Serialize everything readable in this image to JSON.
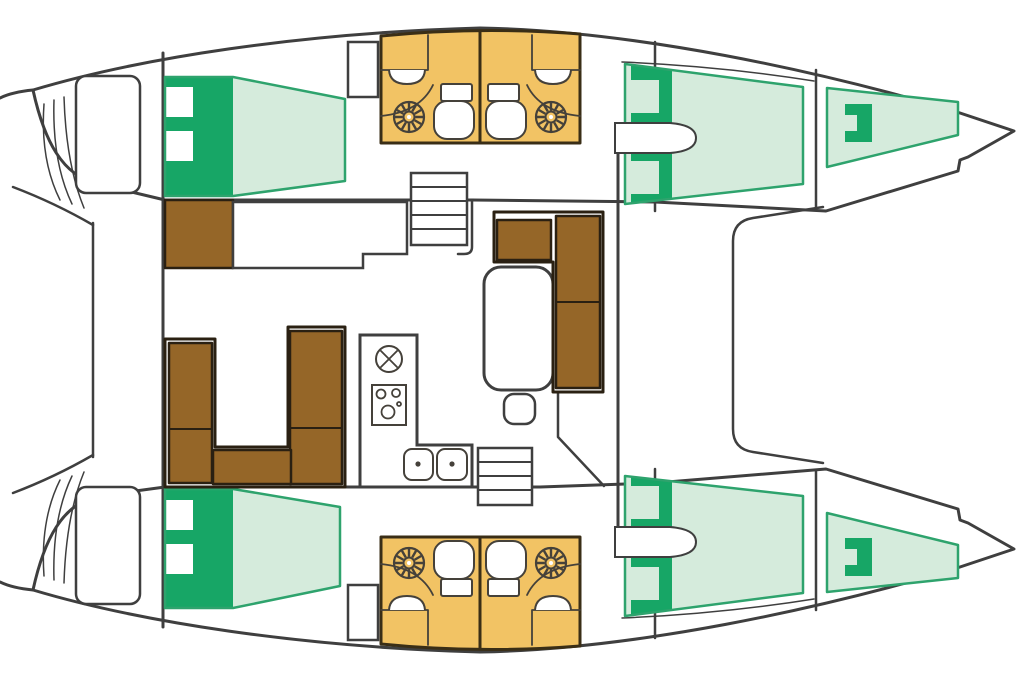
{
  "diagram": {
    "kind": "boat-floor-plan",
    "vessel": {
      "type": "catamaran",
      "view": "deck-plan",
      "bow_direction": "right",
      "stern_direction": "left"
    },
    "inventory": {
      "double_berths": 4,
      "bow_peak_berths": 2,
      "heads": 4,
      "head_fixtures_each": [
        "toilet-icon",
        "vanity-sink-icon",
        "shower-fan-icon"
      ],
      "companionway_stairs": 2,
      "wardrobes": 2,
      "salon": [
        "u-sofa",
        "l-sofa",
        "dining-table",
        "stool",
        "nav-seat",
        "counter"
      ],
      "galley": [
        "round-sink-icon",
        "stove-icon",
        "double-sink-icon"
      ],
      "deck": [
        "trampoline",
        "transom-platforms",
        "transom-steps"
      ]
    }
  },
  "colors": {
    "background": "#ffffff",
    "hull_fill": "#ffffff",
    "outline": "#3f3f3f",
    "berth_light": "#d5ebdc",
    "berth_dark": "#17a666",
    "berth_outline": "#2ea36d",
    "wood": "#956628",
    "wood_outline": "#2a2012",
    "bath": "#f2c364",
    "bath_outline": "#3a2e16",
    "fixture": "#45413a"
  }
}
